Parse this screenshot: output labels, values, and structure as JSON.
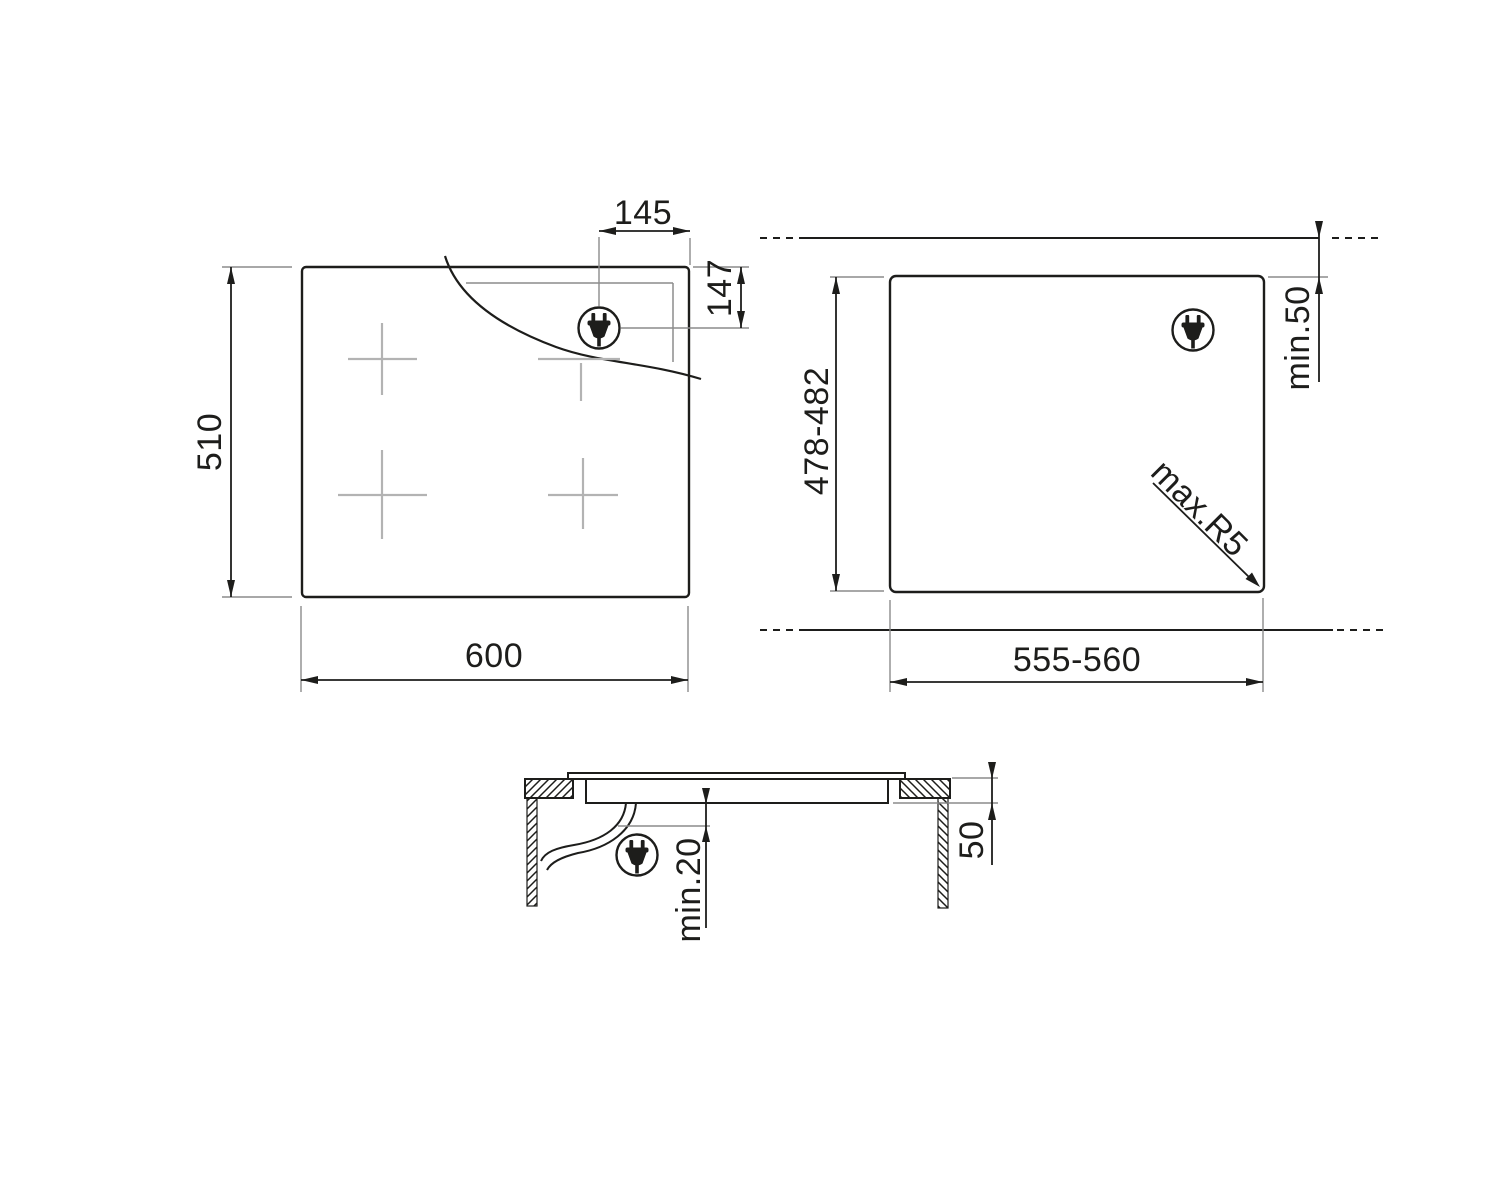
{
  "drawing": {
    "kind": "built-in hob installation dimensions drawing",
    "top_view": {
      "width": "600",
      "height": "510",
      "plug_offset_from_right_edge": "145",
      "plug_offset_from_top_edge": "147"
    },
    "cutout_view": {
      "cutout_width": "555-560",
      "cutout_depth": "478-482",
      "min_rear_clearance": "min.50",
      "max_corner_radius": "max.R5"
    },
    "section_view": {
      "depth_below_worktop": "50",
      "min_clearance_below_hob": "min.20"
    },
    "icons": {
      "plug": "power-plug-icon"
    },
    "colors": {
      "line": "#1d1d1b",
      "extension_line": "#8c8c8c",
      "zone_mark": "#b3b3b3",
      "background": "#ffffff"
    }
  }
}
